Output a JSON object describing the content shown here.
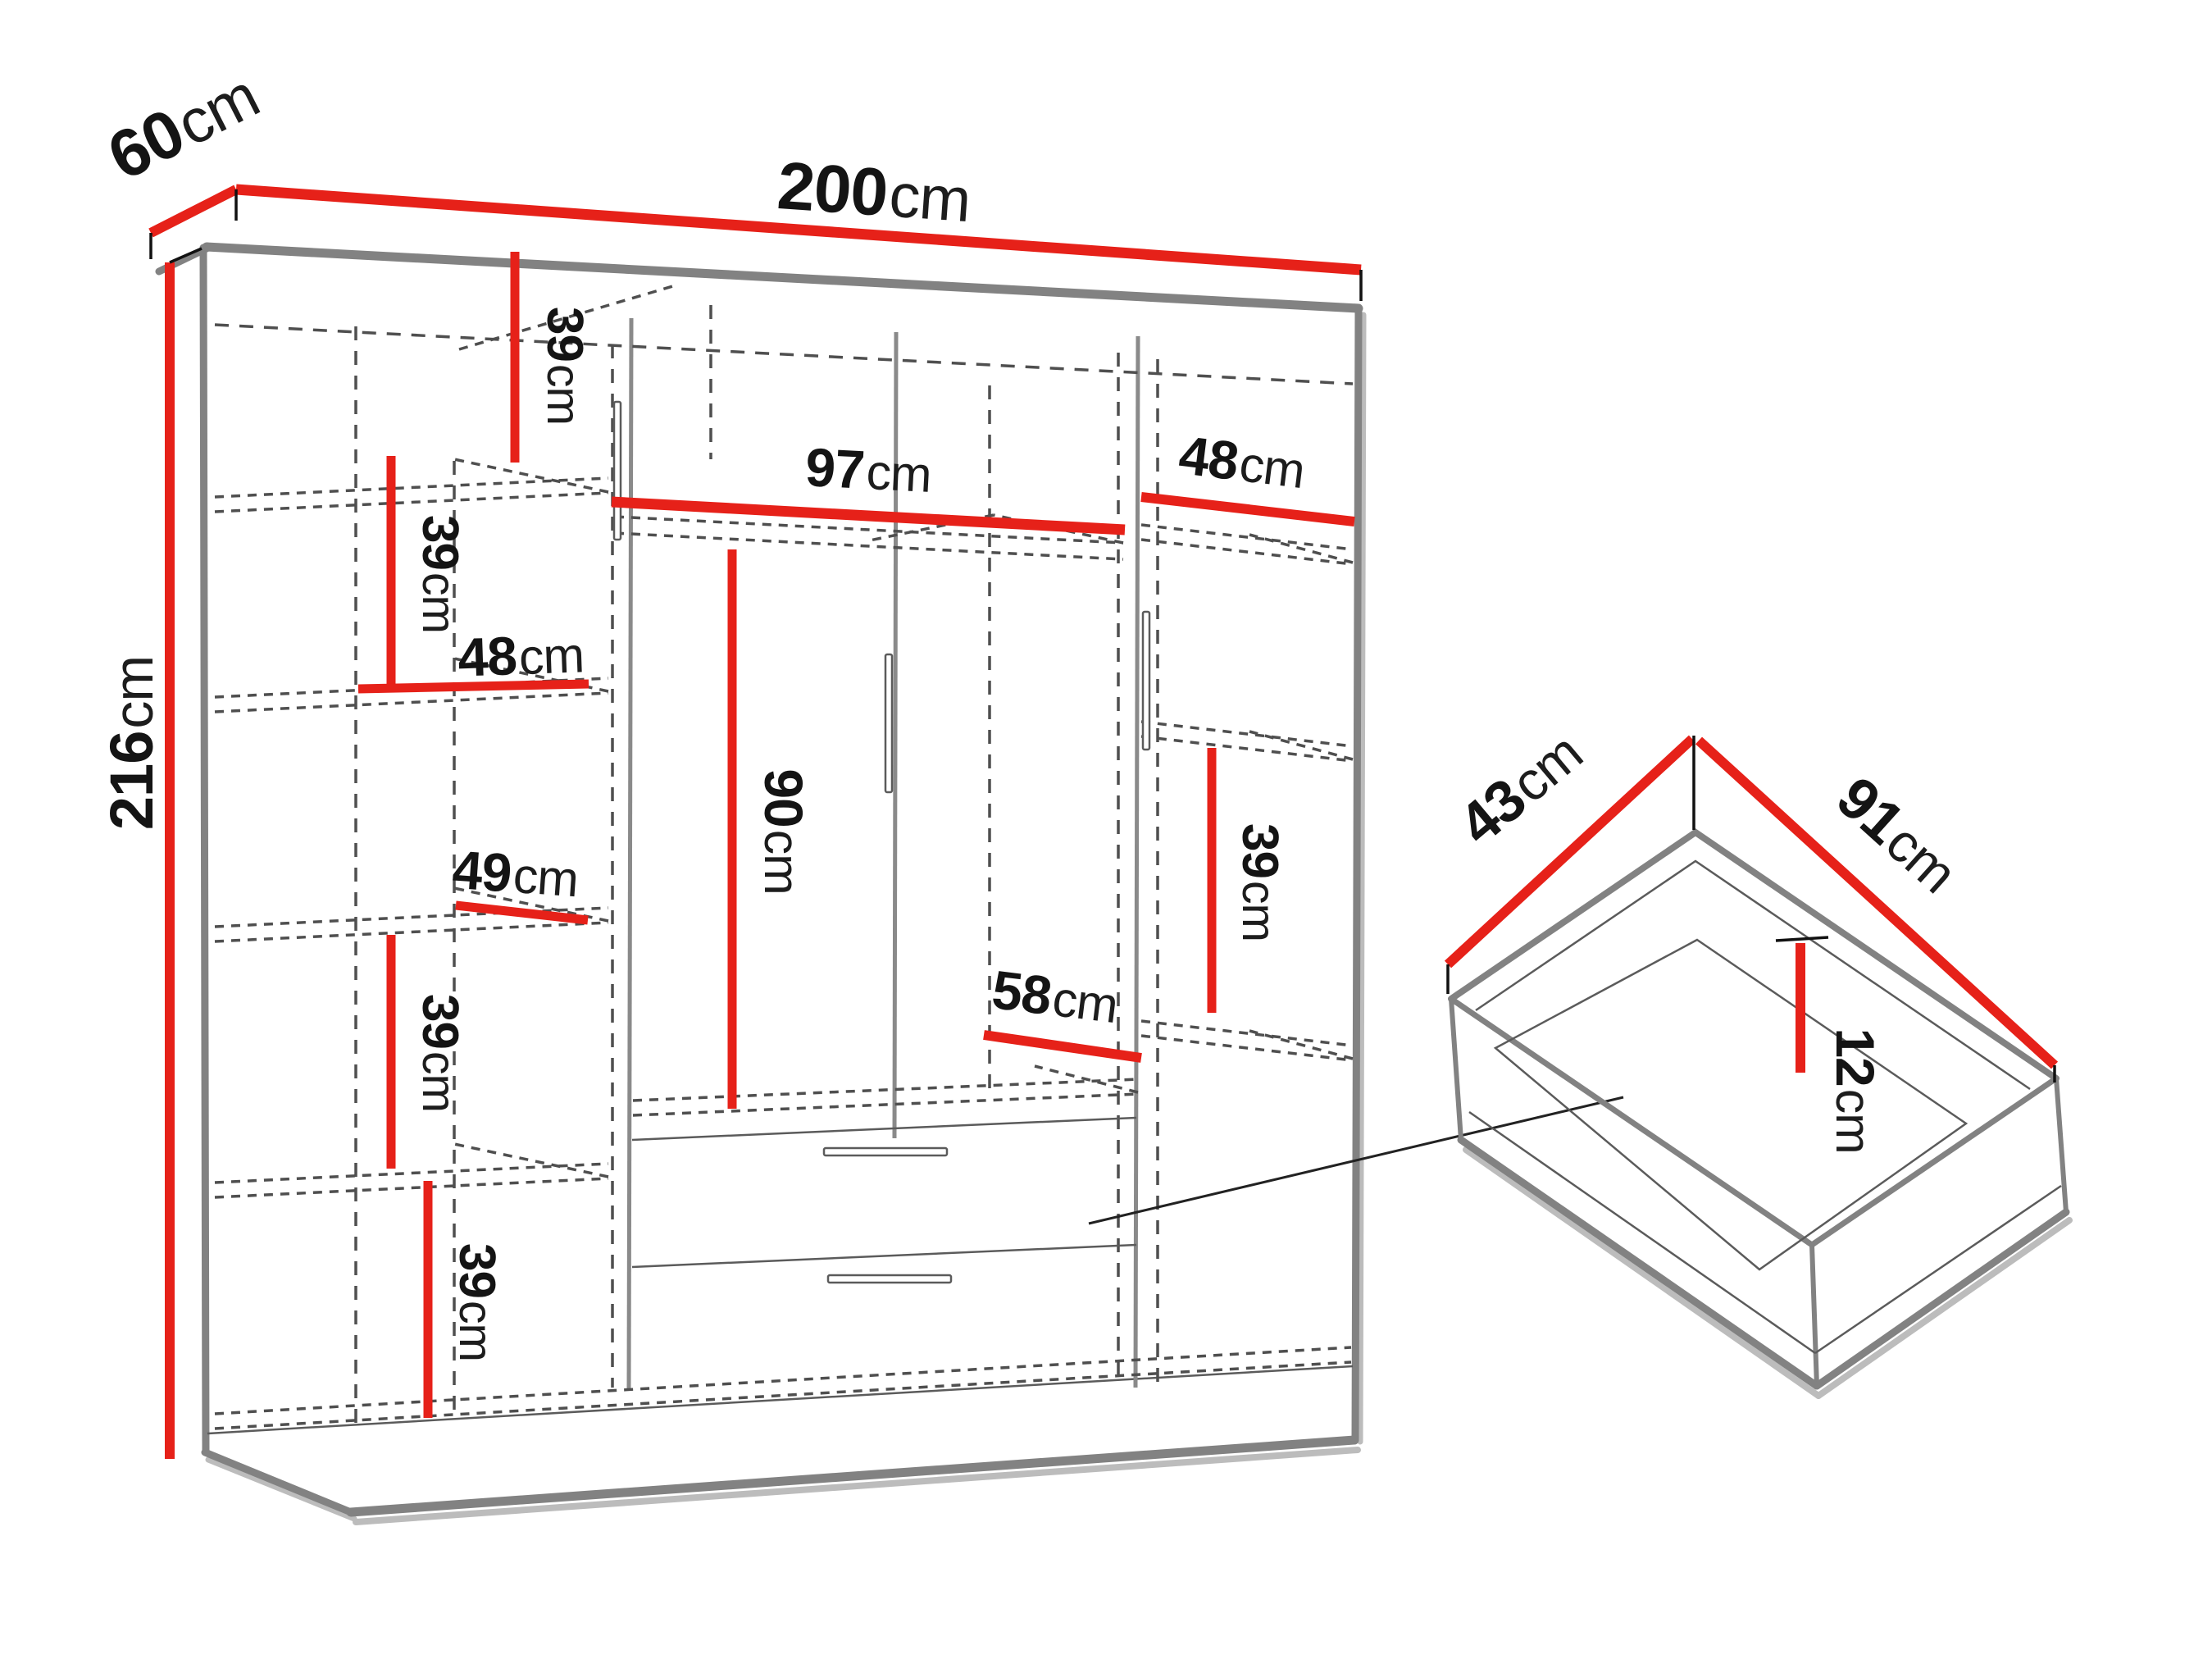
{
  "diagram": {
    "kind": "wardrobe-dimension-diagram",
    "accent_color": "#e62119",
    "edge_color": "#828282",
    "dash_color": "#4f4f4f",
    "text_color": "#141414",
    "background_color": "#ffffff"
  },
  "wardrobe": {
    "width": {
      "value": "200",
      "unit": "cm"
    },
    "depth": {
      "value": "60",
      "unit": "cm"
    },
    "height": {
      "value": "216",
      "unit": "cm"
    },
    "left_column_dims": [
      {
        "id": "shelf-1-height",
        "value": "39",
        "unit": "cm"
      },
      {
        "id": "shelf-2-height",
        "value": "39",
        "unit": "cm"
      },
      {
        "id": "shelf-width",
        "value": "48",
        "unit": "cm"
      },
      {
        "id": "shelf-3-width",
        "value": "49",
        "unit": "cm"
      },
      {
        "id": "shelf-4-height",
        "value": "39",
        "unit": "cm"
      },
      {
        "id": "shelf-5-height",
        "value": "39",
        "unit": "cm"
      }
    ],
    "middle_dims": [
      {
        "id": "hanging-space-width",
        "value": "97",
        "unit": "cm"
      },
      {
        "id": "hanging-space-height",
        "value": "90",
        "unit": "cm"
      },
      {
        "id": "bottom-shelf-width",
        "value": "58",
        "unit": "cm"
      }
    ],
    "right_column_dims": [
      {
        "id": "top-shelf-width",
        "value": "48",
        "unit": "cm"
      },
      {
        "id": "shelf-height",
        "value": "39",
        "unit": "cm"
      }
    ]
  },
  "drawer_detail": {
    "depth": {
      "value": "43",
      "unit": "cm"
    },
    "width": {
      "value": "91",
      "unit": "cm"
    },
    "height": {
      "value": "12",
      "unit": "cm"
    }
  }
}
